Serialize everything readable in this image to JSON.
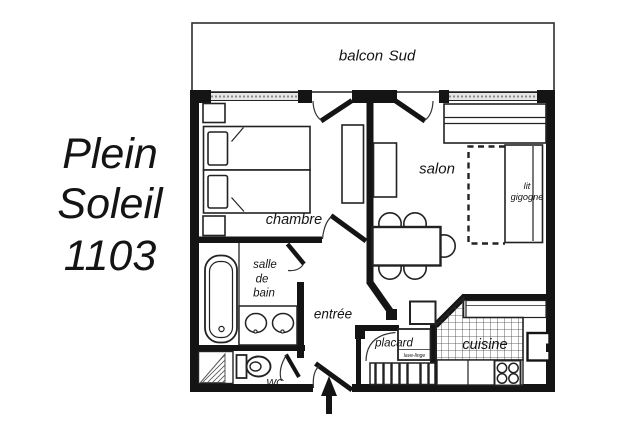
{
  "title": {
    "line1": "Plein",
    "line2": "Soleil",
    "line3": "1103"
  },
  "labels": {
    "balcony_word1": "balcon",
    "balcony_word2": "Sud",
    "bedroom": "chambre",
    "living_room": "salon",
    "trundle_bed_line1": "lit",
    "trundle_bed_line2": "gigogne",
    "bathroom_line1": "salle",
    "bathroom_line2": "de",
    "bathroom_line3": "bain",
    "entry": "entrée",
    "toilet": "WC",
    "closet": "placard",
    "washing_machine": "lave-linge",
    "kitchen": "cuisine"
  },
  "colors": {
    "wall": "#141414",
    "line": "#222222",
    "window_fill": "#e6e6e6",
    "background": "#ffffff"
  }
}
